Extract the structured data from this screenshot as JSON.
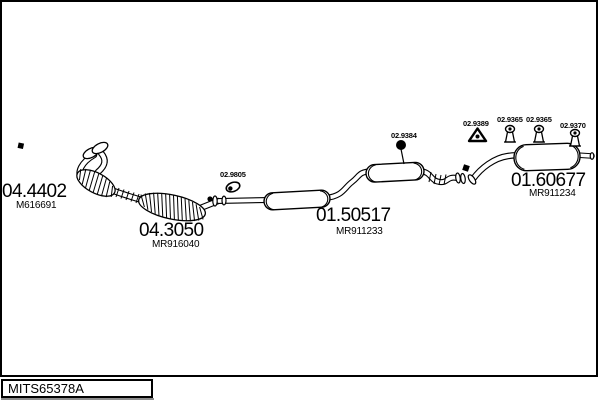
{
  "colors": {
    "line": "#000000",
    "background": "#ffffff",
    "box_shadow": "#8c8c8c"
  },
  "footer": {
    "drawing_code": "MITS65378A"
  },
  "parts": {
    "front_pipe": {
      "number": "04.4402",
      "ref": "M616691"
    },
    "clamp": {
      "number": "02.9805"
    },
    "catalyst": {
      "number": "04.3050",
      "ref": "MR916040"
    },
    "centre_silencer": {
      "number": "01.50517",
      "ref": "MR911233"
    },
    "rear_silencer": {
      "number": "01.60677",
      "ref": "MR911234"
    },
    "hanger_round": {
      "number": "02.9384"
    },
    "hanger_triangle": {
      "number": "02.9389"
    },
    "hanger_mount_1": {
      "number": "02.9365"
    },
    "hanger_mount_2": {
      "number": "02.9365"
    },
    "hanger_mount_3": {
      "number": "02.9370"
    }
  },
  "icons": {
    "bolt_front": "black-square-bolt",
    "bolt_rear": "black-square-bolt",
    "clamp": "pipe-clamp-ring",
    "hanger_round": "rubber-ring-hanger",
    "hanger_triangle": "triangle-rubber-hanger",
    "hanger_mount": "rubber-mount-hanger"
  }
}
